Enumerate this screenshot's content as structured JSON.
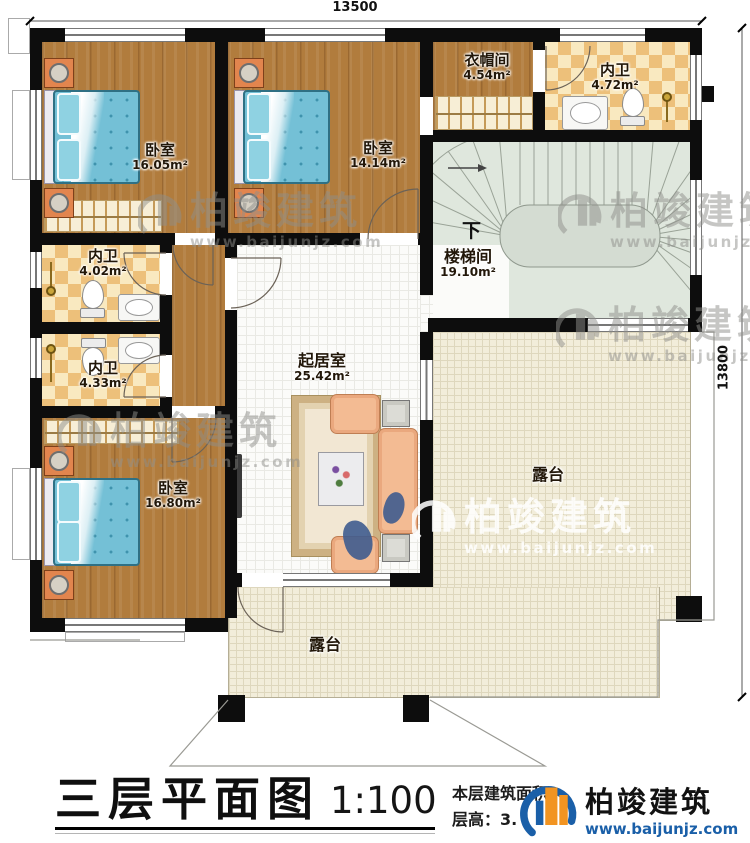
{
  "dimensions": {
    "top": "13500",
    "right": "13800"
  },
  "rooms": {
    "bedroom_top_left": {
      "name": "卧室",
      "area": "16.05m²"
    },
    "bedroom_top_mid": {
      "name": "卧室",
      "area": "14.14m²"
    },
    "cloakroom": {
      "name": "衣帽间",
      "area": "4.54m²"
    },
    "bath_top_right": {
      "name": "内卫",
      "area": "4.72m²"
    },
    "stairwell": {
      "name": "楼梯间",
      "area": "19.10m²",
      "direction_label": "下"
    },
    "bath_mid_upper": {
      "name": "内卫",
      "area": "4.02m²"
    },
    "bath_mid_lower": {
      "name": "内卫",
      "area": "4.33m²"
    },
    "living_room": {
      "name": "起居室",
      "area": "25.42m²"
    },
    "bedroom_bottom_left": {
      "name": "卧室",
      "area": "16.80m²"
    },
    "terrace_right": {
      "name": "露台"
    },
    "terrace_bottom": {
      "name": "露台"
    }
  },
  "title_block": {
    "title": "三层平面图",
    "scale": "1:100",
    "area_label": "本层建筑面积：",
    "floor_height_label": "层高：3."
  },
  "branding": {
    "company": "柏竣建筑",
    "website": "www.baijunjz.com"
  },
  "colors": {
    "wall": "#0d0d0d",
    "wood": "#b17c3d",
    "tile_checker": "#edc07a",
    "terrace": "#f2edda",
    "stair": "#dfe7dd",
    "bed_blue": "#74c0d6",
    "brand_blue": "#1a5fa8",
    "brand_orange": "#f29421"
  }
}
